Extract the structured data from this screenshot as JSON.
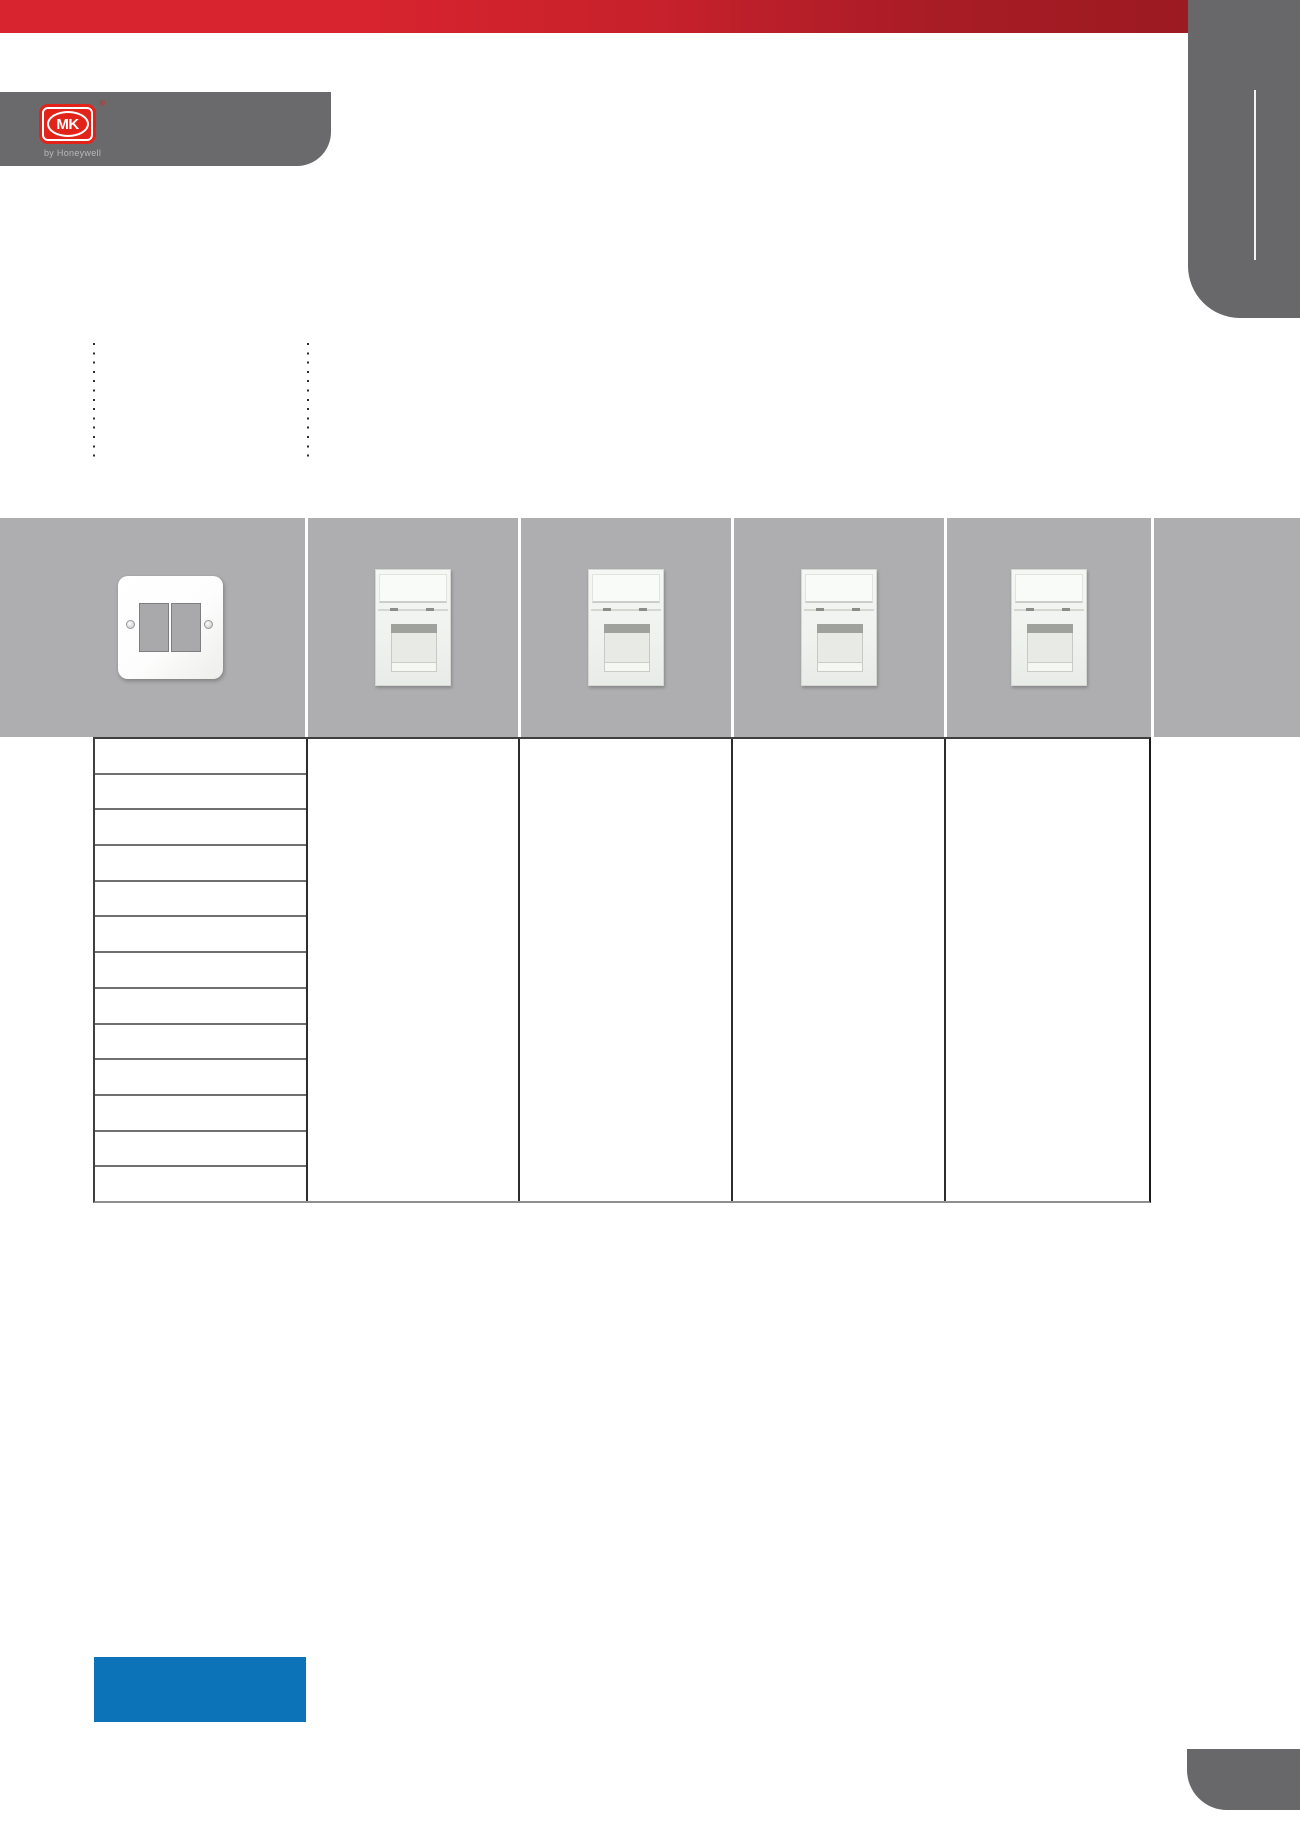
{
  "brand": {
    "logo_text": "MK",
    "registered_mark": "®",
    "tagline": "by Honeywell",
    "logo_color": "#E2231A"
  },
  "colors": {
    "accent_red_left": "#D8242E",
    "accent_red_right": "#9C1A21",
    "tab_gray": "#68686B",
    "band_gray": "#AEAEB0",
    "highlight_blue": "#0D73B9",
    "table_border_dark": "#3F3F3F",
    "table_row_divider": "#707070"
  },
  "header_band": {
    "cells": [
      {
        "icon": "frontplate-2gang-image",
        "label": ""
      },
      {
        "icon": "rj45-module-image",
        "label": ""
      },
      {
        "icon": "rj45-module-image",
        "label": ""
      },
      {
        "icon": "rj45-module-image",
        "label": ""
      },
      {
        "icon": "rj45-module-image",
        "label": ""
      },
      {
        "icon": "",
        "label": ""
      }
    ]
  },
  "table": {
    "rows": [
      "",
      "",
      "",
      "",
      "",
      "",
      "",
      "",
      "",
      "",
      "",
      "",
      ""
    ]
  }
}
